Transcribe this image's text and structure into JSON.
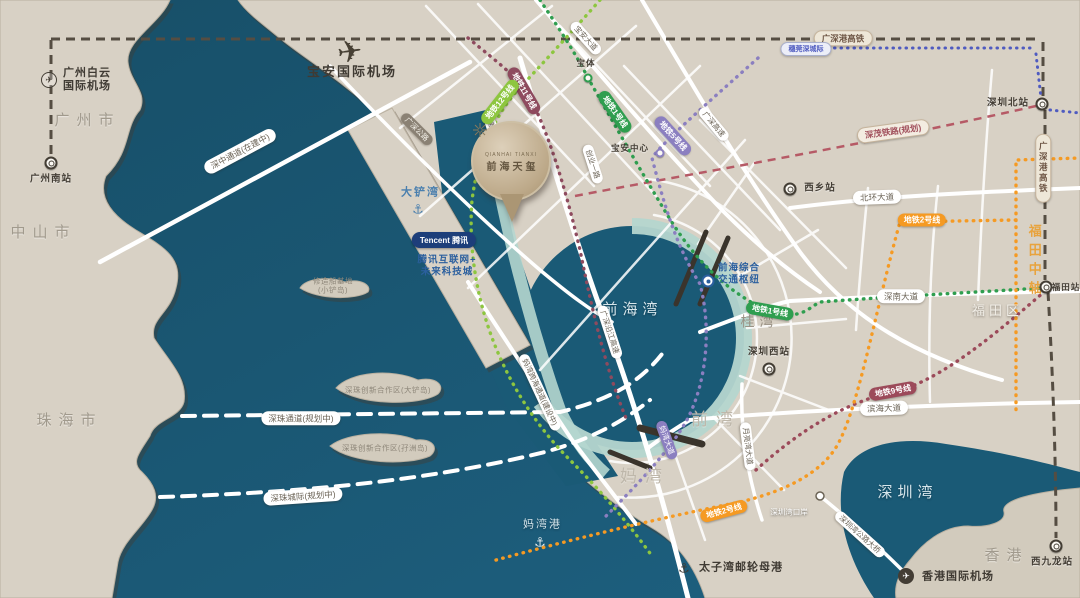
{
  "colors": {
    "sea": "#1a5a76",
    "land": "#d8d1c5",
    "shore_mint": "#b5d6cf",
    "accent_blue": "#2b5f9e",
    "axis_orange": "#e8a33d",
    "metro_line1": "#2f9e4f",
    "metro_line12": "#8dc63f",
    "metro_line5": "#8b7fc0",
    "metro_line11": "#8e4a5e",
    "metro_line9": "#9c4a5a",
    "metro_line2": "#f59a23"
  },
  "regions": {
    "guangzhou": "广州市",
    "zhongshan": "中山市",
    "zhuhai": "珠海市",
    "futian_district": "福田区",
    "hongkong": "香港",
    "guiwan": "桂湾",
    "qianwan": "前湾",
    "mawan": "妈湾",
    "futian_axis": "福田中轴"
  },
  "waters": {
    "qianhai_bay": "前海湾",
    "shenzhen_bay": "深圳湾",
    "dachan_bay": "大铲湾",
    "mawan_port": "妈湾港"
  },
  "places": {
    "baiyun_airport_line1": "广州白云",
    "baiyun_airport_line2": "国际机场",
    "guangzhou_south": "广州南站",
    "baoan_airport": "宝安国际机场",
    "hk_airport": "香港国际机场",
    "taiziwan_port": "太子湾邮轮母港",
    "shenzhen_bay_checkpoint": "深圳湾口岸",
    "tencent_badge": "Tencent 腾讯",
    "tencent_line1": "腾讯互联网+",
    "tencent_line2": "未来科技城",
    "qianhai_hub_line1": "前海综合",
    "qianhai_hub_line2": "交通枢纽",
    "islet_line1": "修造船基地",
    "islet_line2": "(小铲岛)",
    "island_a": "深珠创新合作区(大铲岛)",
    "island_b": "深珠创新合作区(孖洲岛)"
  },
  "stations": {
    "baoti": "宝体",
    "baoan_center": "宝安中心",
    "xixiang": "西乡站",
    "shenzhen_north": "深圳北站",
    "futian": "福田站",
    "shenzhen_west": "深圳西站",
    "west_kowloon": "西九龙站"
  },
  "road_pills": [
    "深中通道(在建中)",
    "深珠通道(规划中)",
    "深珠城际(规划中)",
    "妈湾跨海通道(建设中)",
    "广深沿江高速",
    "广深高速",
    "宝安大道",
    "广深公路",
    "北环大道",
    "深南大道",
    "滨海大道",
    "月亮湾大道",
    "深圳湾公路大桥",
    "妈湾大道",
    "新湖路",
    "创业一路"
  ],
  "rail_pills": [
    "广深港高铁",
    "广深港高铁",
    "深茂铁路(规划)",
    "穗莞深城际"
  ],
  "metro_pills": [
    "地铁1号线",
    "地铁1号线",
    "地铁5号线",
    "地铁11号线",
    "地铁12号线",
    "地铁9号线",
    "地铁2号线",
    "地铁2号线"
  ],
  "landmark": {
    "name_cn": "前海天玺",
    "name_en": "QIANHAI TIANXI"
  }
}
